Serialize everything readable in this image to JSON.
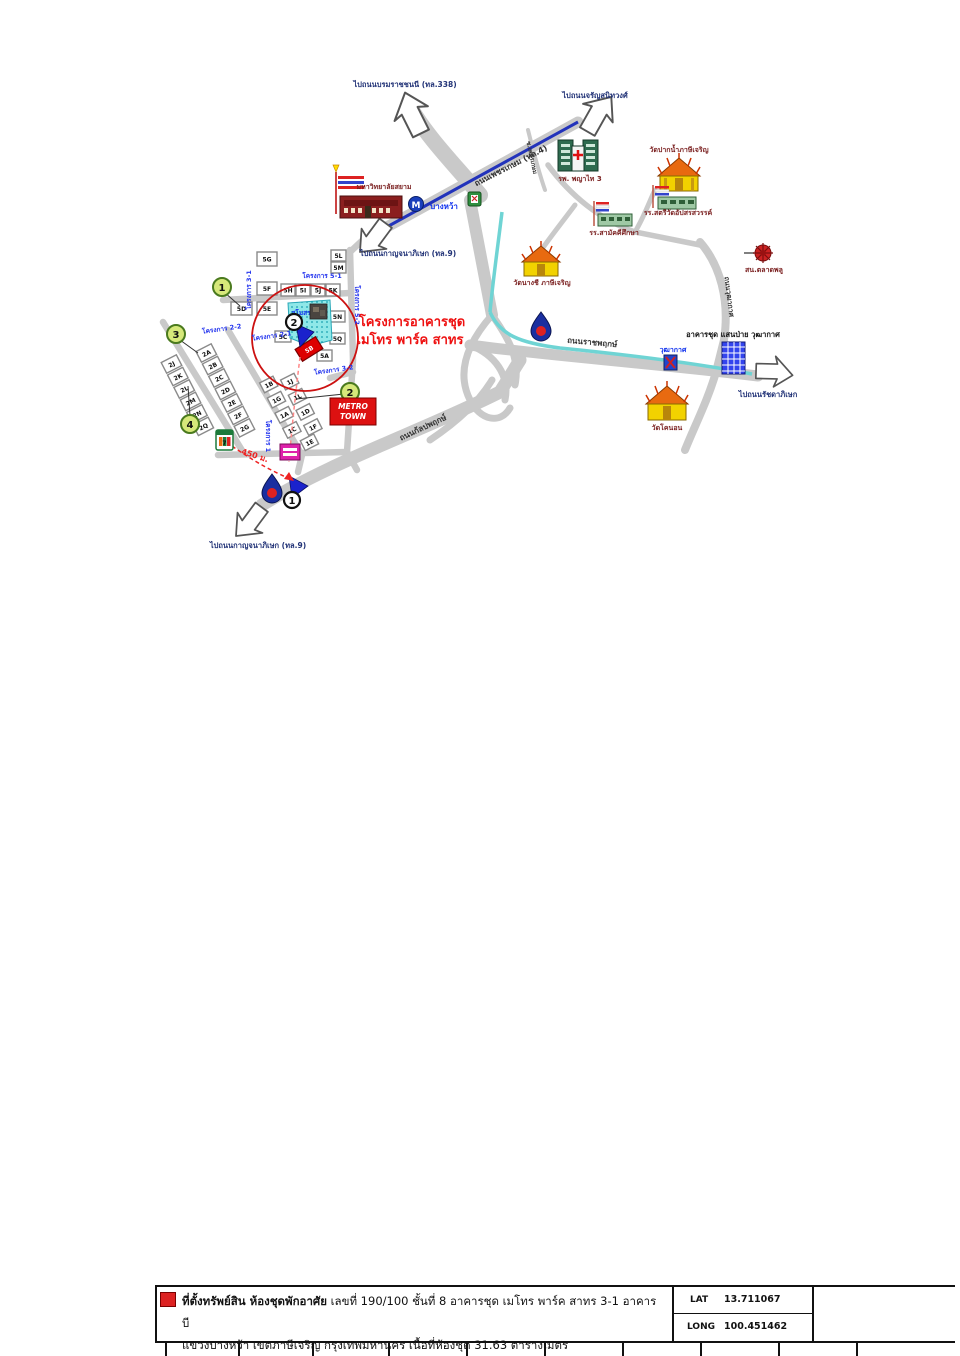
{
  "map": {
    "arrow_labels": {
      "borom": "ไปถนนบรมราชชนนี (ทล.338)",
      "charan": "ไปถนนจรัญสนิทวงศ์",
      "kanchana_mid": "ไปถนนกาญจนาภิเษก (ทล.9)",
      "kanchana_south": "ไปถนนกาญจนาภิเษก (ทล.9)",
      "ratchada": "ไปถนนรัชดาภิเษก"
    },
    "road_labels": {
      "phetkasem": "ถนนเพชรเกษม (ทล.4)",
      "ratchaphruek": "ถนนราชพฤกษ์",
      "kalpaphruek": "ถนนกัลปพฤกษ์",
      "wutthakat": "ถนนวุฒากาศ",
      "soi_phetkasem": "ซ.เพชรเกษม"
    },
    "places": {
      "university": "มหาวิทยาลัยสยาม",
      "hospital": "รพ. พญาไท 3",
      "metro_station": "บางหว้า",
      "temple_paknam": "วัดปากน้ำภาษีเจริญ",
      "school_satri": "รร.สตรีวัดอัปสรสวรรค์",
      "school_samakkhi": "รร.สามัคคีศึกษา",
      "temple_nangchi": "วัดนางชี ภาษีเจริญ",
      "police_station": "สน.ตลาดพลู",
      "bts_station": "วุฒากาศ",
      "condo_wutthakat": "อาคารชุด แสนป่าย วุฒากาศ",
      "temple_khonon": "วัดโคนอน",
      "clubhouse": "สโมสร",
      "metro_town_line1": "METRO",
      "metro_town_line2": "TOWN",
      "distance": "450 ม."
    },
    "project": {
      "line1": "โครงการอาคารชุด",
      "line2": "เมโทร พาร์ค สาทร"
    },
    "sub_projects": {
      "p51": "โครงการ 5-1",
      "p31": "โครงการ 3-1",
      "p52": "โครงการ 5-2",
      "p22": "โครงการ 2-2",
      "p21": "โครงการ 2-1",
      "p1": "โครงการ 1",
      "p32": "โครงการ 3-2"
    },
    "markers": {
      "g1": "1",
      "g2": "2",
      "g3": "3",
      "g4": "4",
      "e1": "1",
      "e2": "2"
    },
    "subject_block": "5B",
    "blocks": {
      "b5": [
        "5G",
        "5F",
        "5E",
        "5D",
        "5H",
        "5I",
        "5J",
        "5K",
        "5L",
        "5M",
        "5N",
        "5Q",
        "5C",
        "5A"
      ],
      "b1": [
        "1B",
        "1J",
        "1G",
        "1L",
        "1A",
        "1D",
        "1C",
        "1F",
        "1E"
      ],
      "b2a": [
        "2J",
        "2K",
        "2L",
        "2M",
        "2N",
        "2Q"
      ],
      "b2b": [
        "2A",
        "2B",
        "2C",
        "2D",
        "2E",
        "2F",
        "2G"
      ]
    }
  },
  "footer": {
    "line1_bold": "ที่ตั้งทรัพย์สิน ห้องชุดพักอาศัย",
    "line1_rest": " เลขที่ 190/100 ชั้นที่ 8 อาคารชุด เมโทร พาร์ค สาทร 3-1 อาคาร บี",
    "line2": "แขวงบางหว้า เขตภาษีเจริญ กรุงเทพมหานคร เนื้อที่ห้องชุด 31.63 ตารางเมตร",
    "lat_label": "LAT",
    "lat_value": "13.711067",
    "long_label": "LONG",
    "long_value": "100.451462"
  }
}
